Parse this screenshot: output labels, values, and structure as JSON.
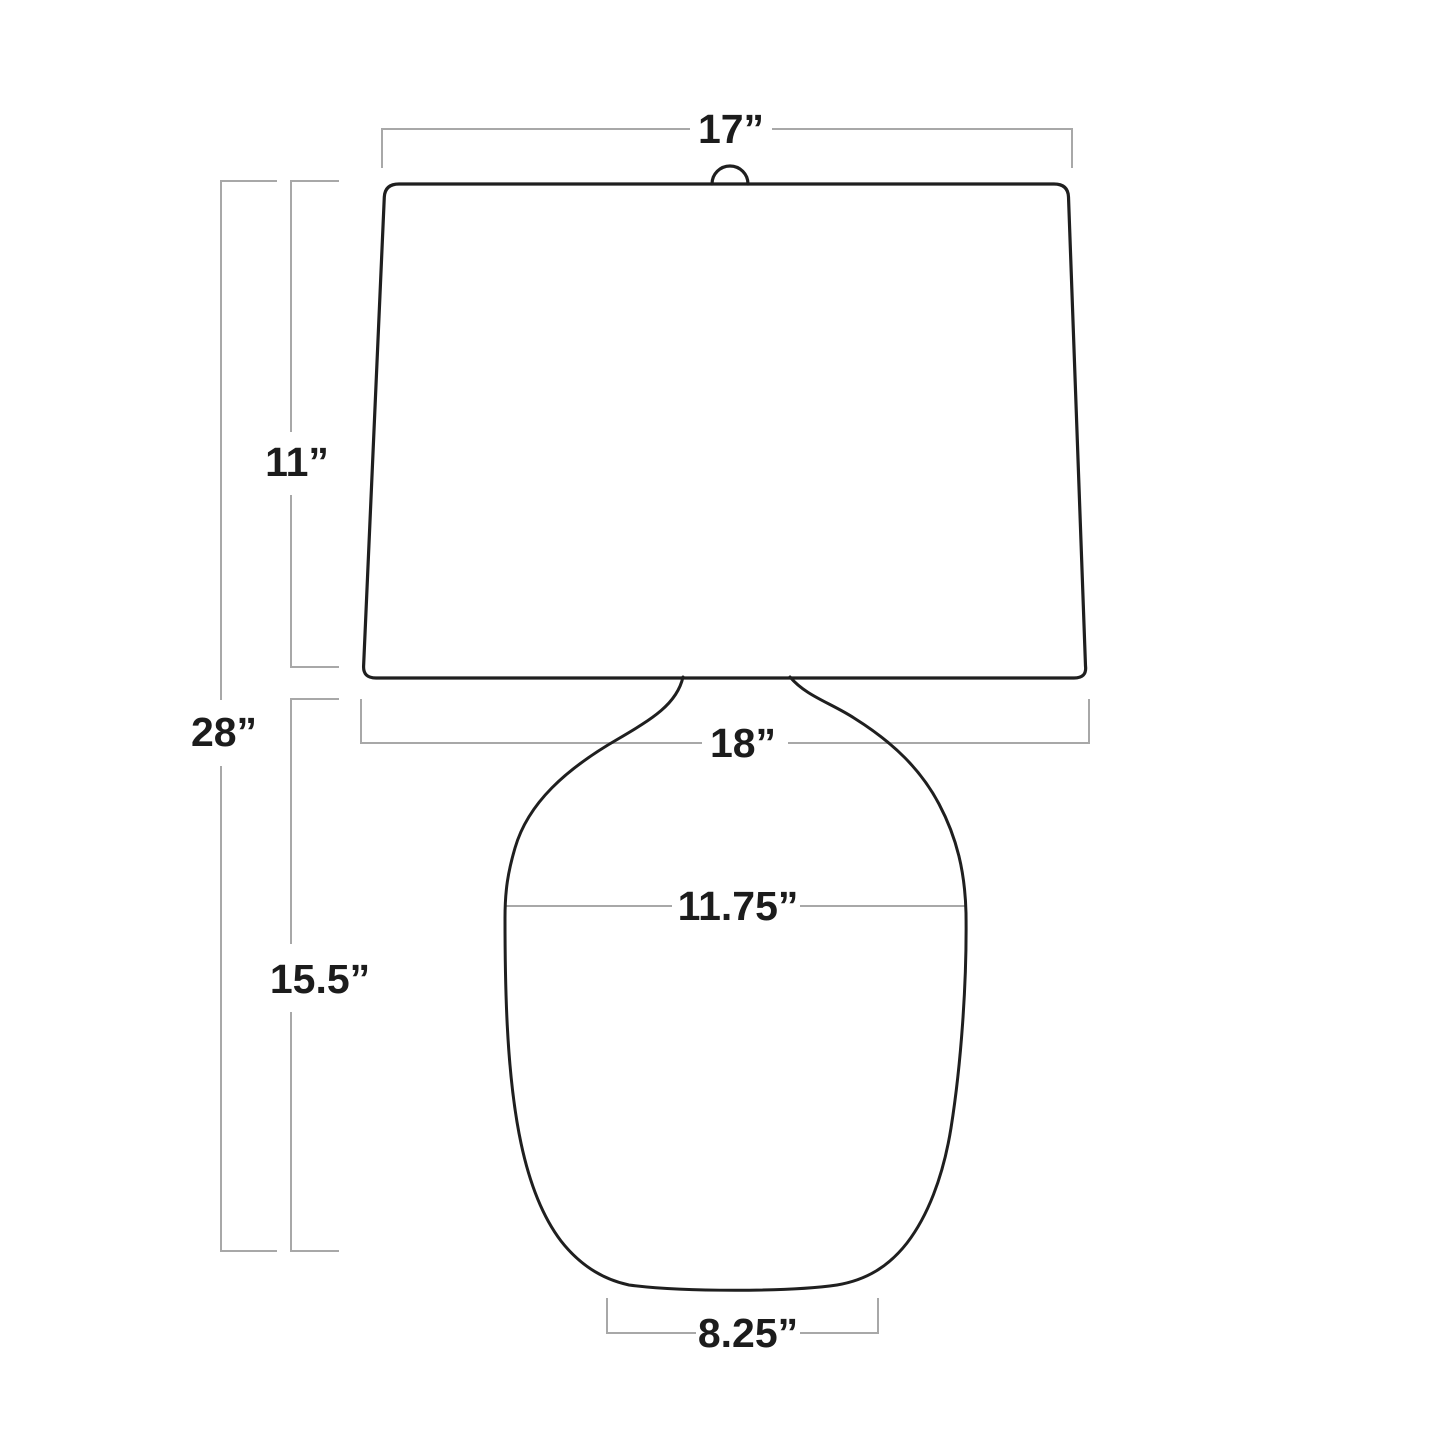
{
  "diagram": {
    "title": "Table lamp dimension line drawing",
    "unit": "inches",
    "colors": {
      "outline": "#1f1f1f",
      "dimension_line": "#a8a8a8",
      "text": "#1c1c1c",
      "background": "#ffffff"
    },
    "labels": {
      "shade_top_width": "17”",
      "shade_height": "11”",
      "overall_height": "28”",
      "shade_bottom_width": "18”",
      "body_max_width": "11.75”",
      "body_height": "15.5”",
      "base_bottom_width": "8.25”"
    },
    "dimensions": [
      {
        "part": "shade top width",
        "value": 17,
        "unit": "in"
      },
      {
        "part": "shade height",
        "value": 11,
        "unit": "in"
      },
      {
        "part": "overall height",
        "value": 28,
        "unit": "in"
      },
      {
        "part": "shade bottom width",
        "value": 18,
        "unit": "in"
      },
      {
        "part": "body max width",
        "value": 11.75,
        "unit": "in"
      },
      {
        "part": "body height",
        "value": 15.5,
        "unit": "in"
      },
      {
        "part": "base bottom width",
        "value": 8.25,
        "unit": "in"
      }
    ]
  }
}
